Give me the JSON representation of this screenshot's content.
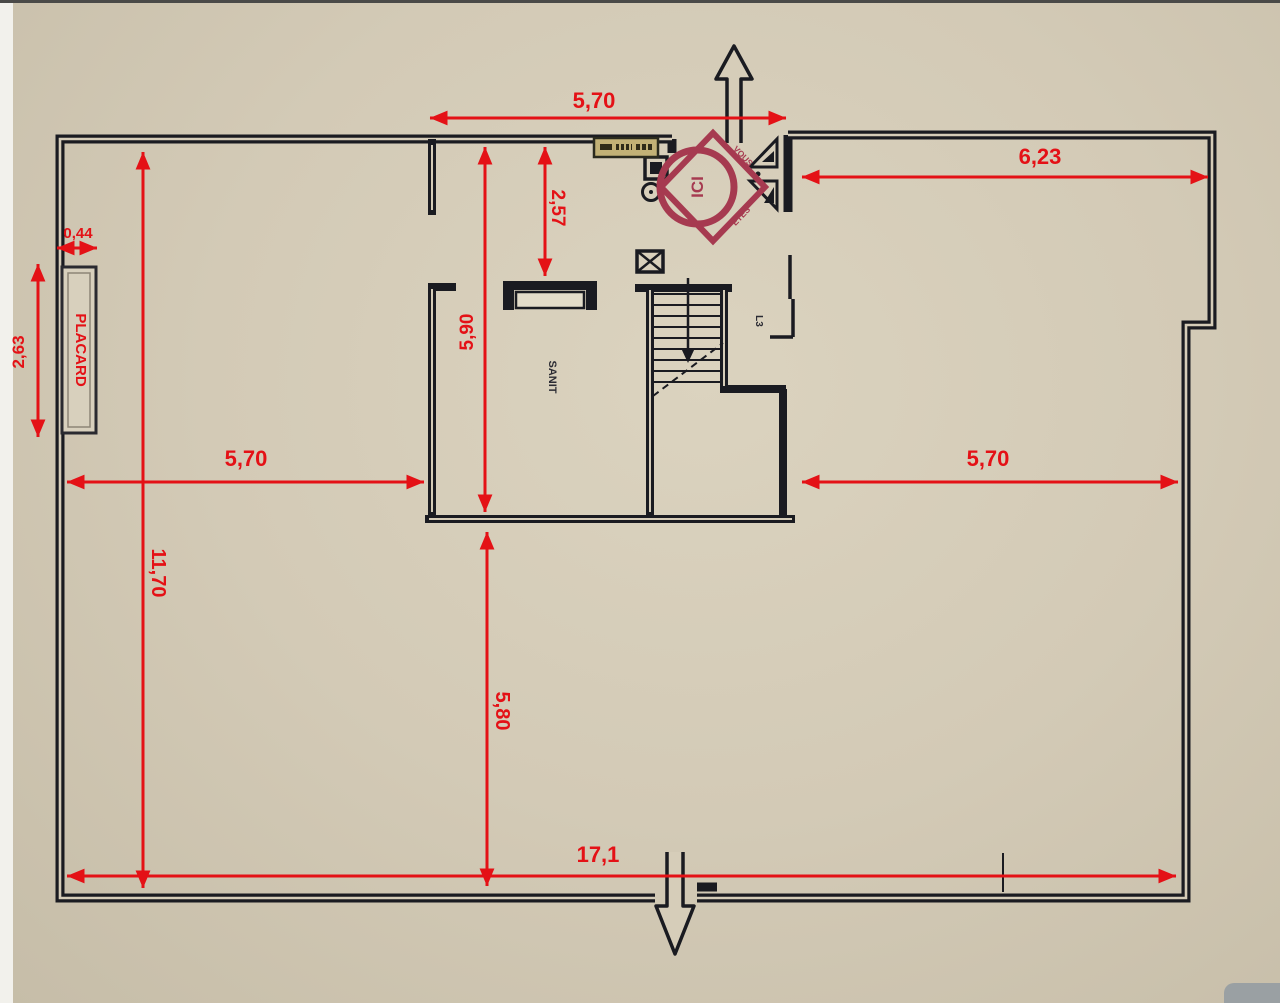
{
  "plan": {
    "dimensions": {
      "top_width": "5,70",
      "upper_right_width": "6,23",
      "wc_depth": "2,57",
      "sanit_height": "5,90",
      "placard_depth": "0,44",
      "placard_height": "2,63",
      "left_mid_width": "5,70",
      "right_mid_width": "5,70",
      "left_height": "11,70",
      "lower_height": "5,80",
      "bottom_width": "17,1"
    },
    "labels": {
      "closet": "PLACARD",
      "sanitary": "SANIT",
      "stair": "L3"
    },
    "stamp": {
      "center": "ICI",
      "arc_upper": "VOUS",
      "arc_lower": "ÊTES"
    },
    "colors": {
      "background": "#d3cab6",
      "walls": "#1a1b21",
      "dimensions": "#e41116",
      "stamp": "#a63a50"
    }
  }
}
